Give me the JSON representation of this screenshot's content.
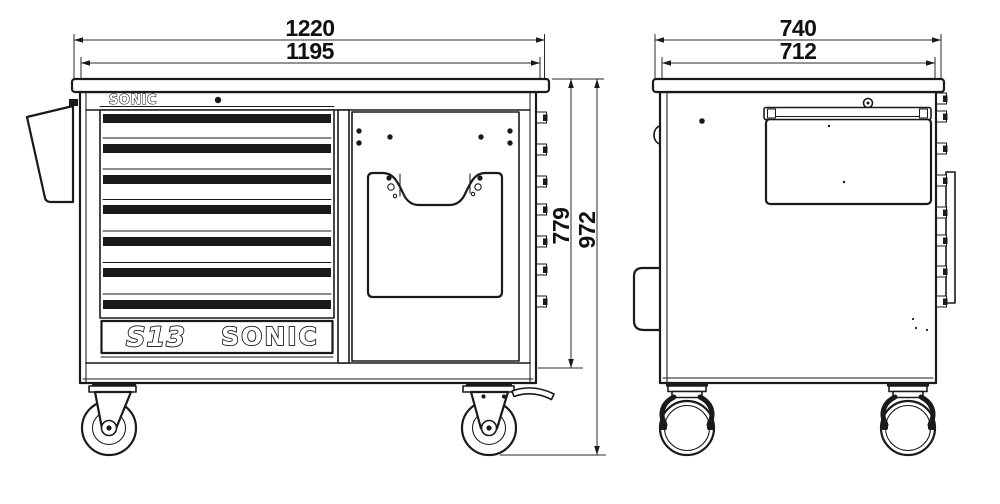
{
  "drawing": {
    "background_color": "#ffffff",
    "line_color": "#1a1a1a",
    "front_view": {
      "dimensions": {
        "overall_width_mm": "1220",
        "worktop_width_mm": "1195",
        "body_height_mm": "779",
        "overall_height_mm": "972"
      },
      "header_logo": "SONIC",
      "badge": {
        "model": "S13",
        "brand": "SONIC"
      },
      "drawer_count": 7
    },
    "side_view": {
      "dimensions": {
        "overall_depth_mm": "740",
        "worktop_depth_mm": "712"
      }
    }
  }
}
